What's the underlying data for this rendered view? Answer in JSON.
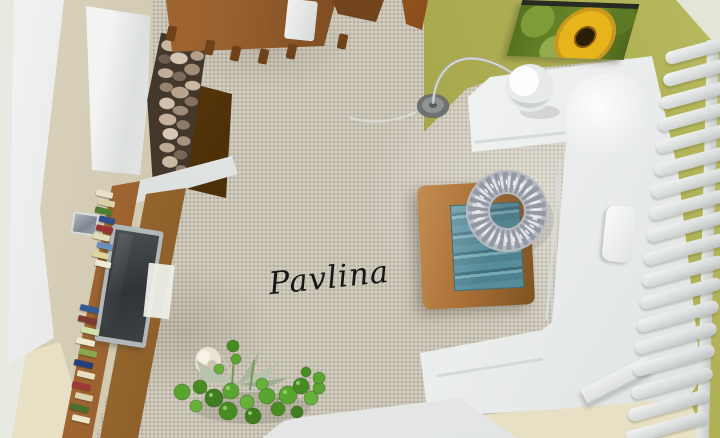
{
  "scene": {
    "description": "3D bird's-eye render of a living room interior",
    "watermark": "Pavlina"
  },
  "colors": {
    "floor": "#c9c3b4",
    "wall-pale": "#e6eae1",
    "wall-beige": "#dbd3bc",
    "wall-cream": "#e7e0c5",
    "wall-white": "#f2f4f3",
    "wall-white-shade": "#d8dcdb",
    "wall-green": "#a4a54a",
    "wall-green-light": "#b8b95e",
    "wall-green-dark": "#8e903e",
    "panel-brown": "#6b4514",
    "wood": "#9a6130",
    "wood-light": "#a96f35",
    "wood-dark": "#6f421a",
    "tv-frame": "#b2b8ba",
    "tv-screen": "#303436",
    "sofa-white": "#f5f7f6",
    "sofa-shade": "#dde1e0",
    "glass-teal-1": "#578d9b",
    "glass-teal-2": "#3f6f7d",
    "glass-teal-3": "#79aab4",
    "radiator-fin": "#f2f4f3",
    "radiator-fin-shade": "#b9bdbc",
    "chrome": "#b2b7b5",
    "lamp-shade": "#eceeed",
    "plant-green": "#59a530",
    "plant-green-dark": "#478c23",
    "vase-cream": "#e9e3d2",
    "sunflower-yellow": "#e7b41c",
    "sunflower-center": "#2c1d08",
    "sunflower-leaf": "#6f8c2c",
    "painting-frame": "#262a20",
    "watermark-ink": "#161616"
  },
  "objects": {
    "dining_area": {
      "table": "wooden dining table",
      "chairs": "wooden chairs",
      "white_chair": "white chair"
    },
    "kitchen_corner": {
      "cabinet": "white cabinet block",
      "stone_pillar": "river-stone clad pillar",
      "counter": "dark brown counter"
    },
    "tv_wall": {
      "unit": "oak tv wall unit",
      "tv": "flat-screen tv",
      "books": "shelved books",
      "picture": "small wall picture",
      "book_colors": [
        "#e8e2c9",
        "#d9d3a8",
        "#4e7b2e",
        "#2f4e8a",
        "#993333",
        "#e4dcb8",
        "#6a90bf",
        "#ddd3a0",
        "#f0ead2",
        "#365a96",
        "#7c3a30",
        "#cfe0a8",
        "#efe9cf",
        "#8aa84f",
        "#24407c",
        "#e6dfc0",
        "#a03838",
        "#dbd4ae",
        "#49702a",
        "#ece5ca"
      ]
    },
    "lounge": {
      "sofa": "white corner sofa",
      "pillow": "white cushion",
      "coffee_table": "oak coffee table with teal glass inset",
      "wreath": "silver beaded wreath",
      "lamp": "chrome arc floor lamp with globe shade",
      "painting": "sunflower canvas on green wall",
      "radiator": {
        "label": "white finned radiator",
        "fin_count": 18
      },
      "plant": "green potted plant",
      "vase": "cream vase",
      "side_table": "white side table"
    }
  }
}
